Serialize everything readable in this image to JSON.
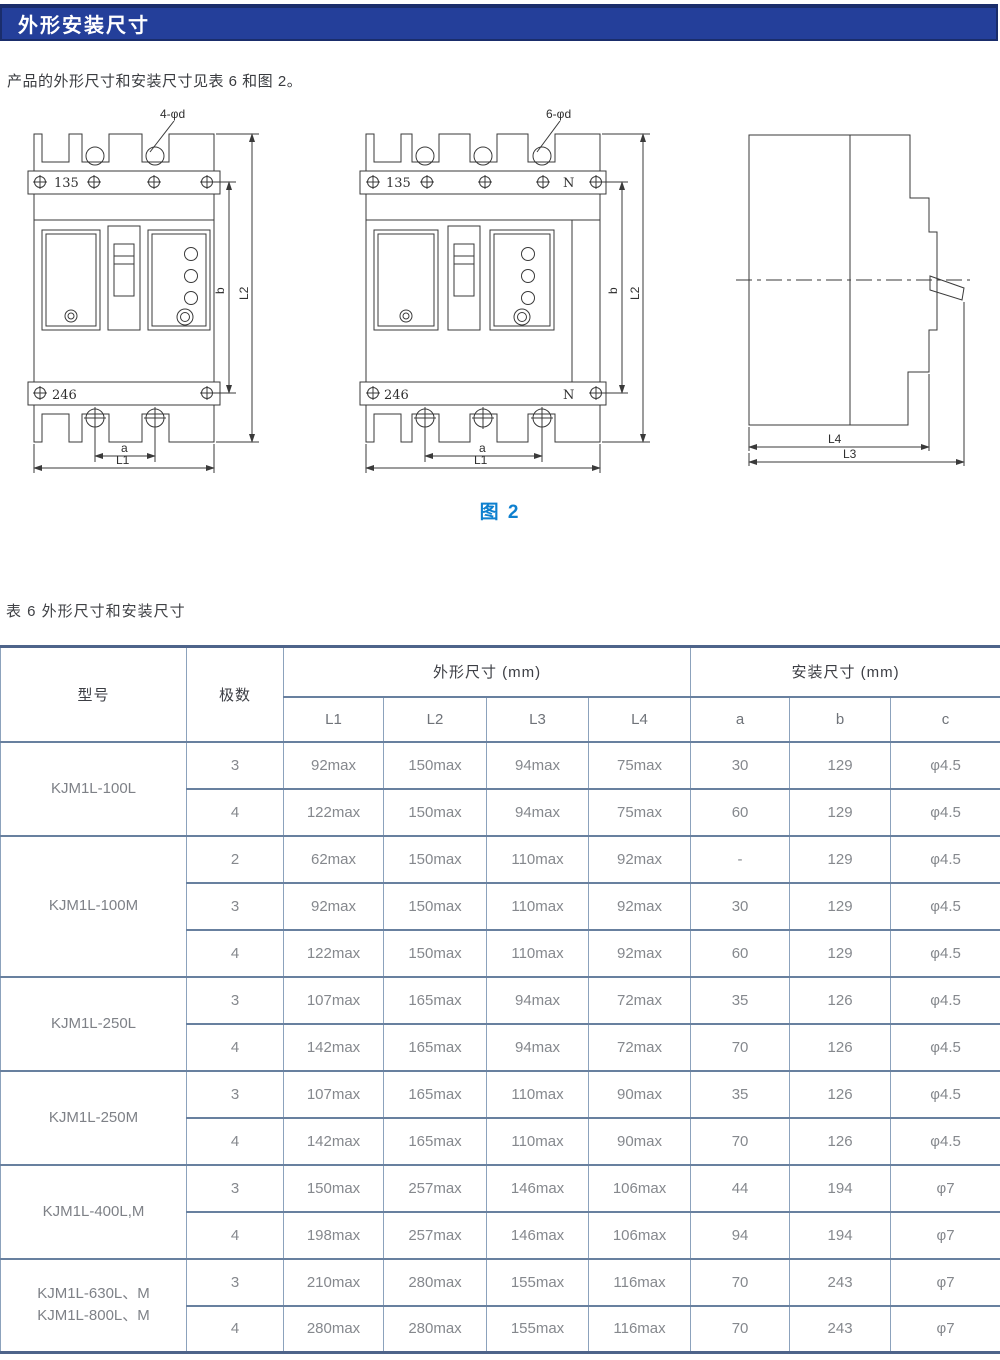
{
  "header": {
    "title": "外形安装尺寸",
    "bar_color": "#243F9A"
  },
  "intro": "产品的外形尺寸和安装尺寸见表 6 和图 2。",
  "figure": {
    "caption": "图 2",
    "caption_color": "#0E80CF",
    "front3": {
      "holes_label": "4-φd",
      "top_width": "135",
      "bottom_width": "246",
      "dim_a": "a",
      "dim_l1": "L1",
      "dim_b": "b",
      "dim_l2": "L2"
    },
    "front4": {
      "holes_label": "6-φd",
      "top_width": "135",
      "bottom_width": "246",
      "neutral_top": "N",
      "neutral_bottom": "N",
      "dim_a": "a",
      "dim_l1": "L1",
      "dim_b": "b",
      "dim_l2": "L2"
    },
    "side": {
      "dim_l4": "L4",
      "dim_l3": "L3"
    }
  },
  "table": {
    "title": "表 6 外形尺寸和安装尺寸",
    "headers": {
      "model": "型号",
      "poles": "极数",
      "outline_group": "外形尺寸 (mm)",
      "mount_group": "安装尺寸 (mm)",
      "cols": [
        "L1",
        "L2",
        "L3",
        "L4",
        "a",
        "b",
        "c"
      ]
    },
    "groups": [
      {
        "model": [
          "KJM1L-100L"
        ],
        "rows": [
          {
            "poles": "3",
            "l1": "92max",
            "l2": "150max",
            "l3": "94max",
            "l4": "75max",
            "a": "30",
            "b": "129",
            "c": "φ4.5"
          },
          {
            "poles": "4",
            "l1": "122max",
            "l2": "150max",
            "l3": "94max",
            "l4": "75max",
            "a": "60",
            "b": "129",
            "c": "φ4.5"
          }
        ]
      },
      {
        "model": [
          "KJM1L-100M"
        ],
        "rows": [
          {
            "poles": "2",
            "l1": "62max",
            "l2": "150max",
            "l3": "110max",
            "l4": "92max",
            "a": "-",
            "b": "129",
            "c": "φ4.5"
          },
          {
            "poles": "3",
            "l1": "92max",
            "l2": "150max",
            "l3": "110max",
            "l4": "92max",
            "a": "30",
            "b": "129",
            "c": "φ4.5"
          },
          {
            "poles": "4",
            "l1": "122max",
            "l2": "150max",
            "l3": "110max",
            "l4": "92max",
            "a": "60",
            "b": "129",
            "c": "φ4.5"
          }
        ]
      },
      {
        "model": [
          "KJM1L-250L"
        ],
        "rows": [
          {
            "poles": "3",
            "l1": "107max",
            "l2": "165max",
            "l3": "94max",
            "l4": "72max",
            "a": "35",
            "b": "126",
            "c": "φ4.5"
          },
          {
            "poles": "4",
            "l1": "142max",
            "l2": "165max",
            "l3": "94max",
            "l4": "72max",
            "a": "70",
            "b": "126",
            "c": "φ4.5"
          }
        ]
      },
      {
        "model": [
          "KJM1L-250M"
        ],
        "rows": [
          {
            "poles": "3",
            "l1": "107max",
            "l2": "165max",
            "l3": "110max",
            "l4": "90max",
            "a": "35",
            "b": "126",
            "c": "φ4.5"
          },
          {
            "poles": "4",
            "l1": "142max",
            "l2": "165max",
            "l3": "110max",
            "l4": "90max",
            "a": "70",
            "b": "126",
            "c": "φ4.5"
          }
        ]
      },
      {
        "model": [
          "KJM1L-400L,M"
        ],
        "rows": [
          {
            "poles": "3",
            "l1": "150max",
            "l2": "257max",
            "l3": "146max",
            "l4": "106max",
            "a": "44",
            "b": "194",
            "c": "φ7"
          },
          {
            "poles": "4",
            "l1": "198max",
            "l2": "257max",
            "l3": "146max",
            "l4": "106max",
            "a": "94",
            "b": "194",
            "c": "φ7"
          }
        ]
      },
      {
        "model": [
          "KJM1L-630L、M",
          "KJM1L-800L、M"
        ],
        "rows": [
          {
            "poles": "3",
            "l1": "210max",
            "l2": "280max",
            "l3": "155max",
            "l4": "116max",
            "a": "70",
            "b": "243",
            "c": "φ7"
          },
          {
            "poles": "4",
            "l1": "280max",
            "l2": "280max",
            "l3": "155max",
            "l4": "116max",
            "a": "70",
            "b": "243",
            "c": "φ7"
          }
        ]
      }
    ]
  }
}
